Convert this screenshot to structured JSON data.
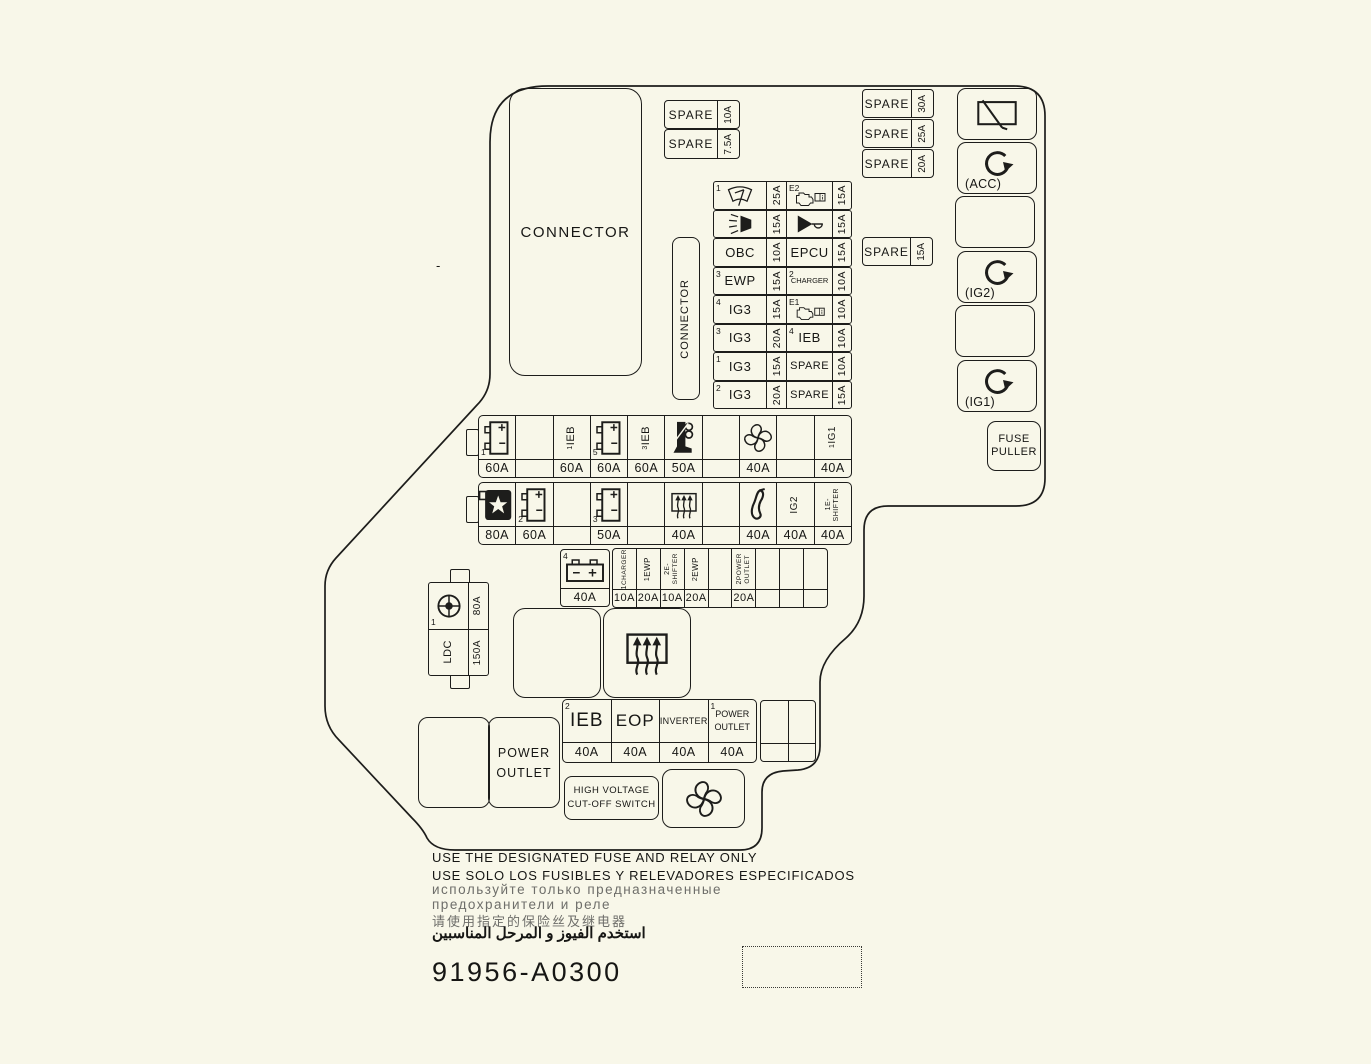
{
  "colors": {
    "bg": "#f8f7e9",
    "line": "#1d1d1b"
  },
  "dash": "-",
  "connector_big": "CONNECTOR",
  "connector_side": "CONNECTOR",
  "spare_left": [
    {
      "label": "SPARE",
      "amp": "10A"
    },
    {
      "label": "SPARE",
      "amp": "7.5A"
    }
  ],
  "spare_right": [
    {
      "label": "SPARE",
      "amp": "30A"
    },
    {
      "label": "SPARE",
      "amp": "25A"
    },
    {
      "label": "SPARE",
      "amp": "20A"
    }
  ],
  "spare_mid": {
    "label": "SPARE",
    "amp": "15A"
  },
  "relays": {
    "acc": "(ACC)",
    "ig2": "(IG2)",
    "ig1": "(IG1)"
  },
  "fuse_puller": {
    "l1": "FUSE",
    "l2": "PULLER"
  },
  "grid": {
    "r1c1": {
      "sup": "1",
      "amp": "25A"
    },
    "r1c2": {
      "sup": "E2",
      "amp": "15A"
    },
    "r2c1": {
      "amp": "15A"
    },
    "r2c2": {
      "amp": "15A"
    },
    "r3c1": {
      "label": "OBC",
      "amp": "10A"
    },
    "r3c2": {
      "label": "EPCU",
      "amp": "15A"
    },
    "r4c1": {
      "sup": "3",
      "label": "EWP",
      "amp": "15A"
    },
    "r4c2": {
      "sup": "2",
      "label": "CHARGER",
      "amp": "10A"
    },
    "r5c1": {
      "sup": "4",
      "label": "IG3",
      "amp": "15A"
    },
    "r5c2": {
      "sup": "E1",
      "amp": "10A"
    },
    "r6c1": {
      "sup": "3",
      "label": "IG3",
      "amp": "20A"
    },
    "r6c2": {
      "sup": "4",
      "label": "IEB",
      "amp": "10A"
    },
    "r7c1": {
      "sup": "1",
      "label": "IG3",
      "amp": "15A"
    },
    "r7c2": {
      "label": "SPARE",
      "amp": "10A"
    },
    "r8c1": {
      "sup": "2",
      "label": "IG3",
      "amp": "20A"
    },
    "r8c2": {
      "label": "SPARE",
      "amp": "15A"
    }
  },
  "rowA": [
    {
      "sup": "1",
      "amp": "60A"
    },
    {},
    {
      "sup": "1",
      "vlabel": "IEB",
      "amp": "60A"
    },
    {
      "sup": "5",
      "amp": "60A"
    },
    {
      "sup": "3",
      "vlabel": "IEB",
      "amp": "60A"
    },
    {
      "amp": "50A"
    },
    {},
    {
      "amp": "40A"
    },
    {},
    {
      "sup": "1",
      "vlabel": "IG1",
      "amp": "40A"
    }
  ],
  "rowB": [
    {
      "amp": "80A"
    },
    {
      "sup": "2",
      "amp": "60A"
    },
    {},
    {
      "sup": "3",
      "amp": "50A"
    },
    {},
    {
      "amp": "40A"
    },
    {},
    {
      "amp": "40A"
    },
    {
      "vlabel": "IG2",
      "amp": "40A"
    },
    {
      "sup": "1",
      "l1": "E-",
      "l2": "SHIFTER",
      "amp": "40A"
    }
  ],
  "battery4": {
    "sup": "4",
    "amp": "40A"
  },
  "rowC": [
    {
      "sup": "1",
      "vlabel": "CHARGER",
      "amp": "10A"
    },
    {
      "sup": "1",
      "vlabel": "EWP",
      "amp": "20A"
    },
    {
      "sup": "2",
      "l1": "E-",
      "l2": "SHIFTER",
      "amp": "10A"
    },
    {
      "sup": "2",
      "vlabel": "EWP",
      "amp": "20A"
    },
    {},
    {
      "sup": "2",
      "l1": "POWER",
      "l2": "OUTLET",
      "amp": "20A"
    },
    {},
    {},
    {}
  ],
  "ldc": {
    "sup": "1",
    "amp_top": "80A",
    "label": "LDC",
    "amp_bottom": "150A"
  },
  "rowD": [
    {
      "sup": "2",
      "label": "IEB",
      "amp": "40A"
    },
    {
      "label": "EOP",
      "amp": "40A"
    },
    {
      "label": "INVERTER",
      "amp": "40A"
    },
    {
      "sup": "1",
      "l1": "POWER",
      "l2": "OUTLET",
      "amp": "40A"
    }
  ],
  "power_outlet": {
    "l1": "POWER",
    "l2": "OUTLET"
  },
  "hv_switch": {
    "l1": "HIGH VOLTAGE",
    "l2": "CUT-OFF SWITCH"
  },
  "footer": {
    "l1": "USE THE DESIGNATED FUSE AND RELAY ONLY",
    "l2": "USE SOLO LOS FUSIBLES Y RELEVADORES ESPECIFICADOS",
    "l3": "используйте только предназначенные",
    "l4": "предохранители и реле",
    "l5": "请使用指定的保险丝及继电器",
    "l6": "استخدم الفيوز و المرحل المناسبين"
  },
  "part_number": "91956-A0300"
}
